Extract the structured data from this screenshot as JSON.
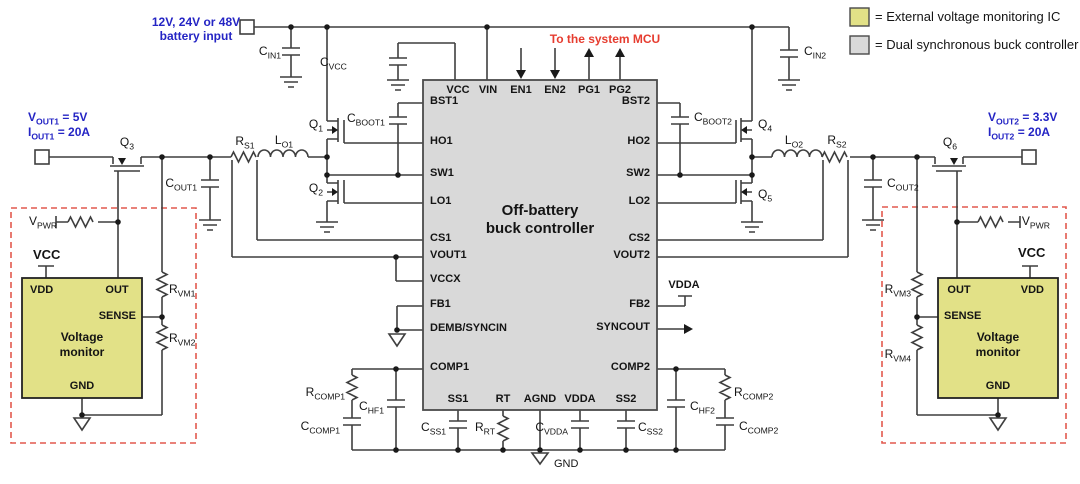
{
  "legend": {
    "items": [
      {
        "label": "= External voltage monitoring IC",
        "swatch_color": "#e2e187"
      },
      {
        "label": "= Dual synchronous buck controller",
        "swatch_color": "#d9d9d9"
      }
    ]
  },
  "annotations": {
    "battery_input": {
      "line1": "12V, 24V or 48V",
      "line2": "battery input"
    },
    "to_mcu": "To the system MCU",
    "out1_v": {
      "m": "V",
      "s": "OUT1",
      "r": " = 5V"
    },
    "out1_i": {
      "m": "I",
      "s": "OUT1",
      "r": " = 20A"
    },
    "out2_v": {
      "m": "V",
      "s": "OUT2",
      "r": " = 3.3V"
    },
    "out2_i": {
      "m": "I",
      "s": "OUT2",
      "r": " = 20A"
    },
    "vdda_rail": "VDDA",
    "gnd": "GND",
    "vcc_left": "VCC",
    "vcc_right": "VCC",
    "vpwr_left": {
      "m": "V",
      "s": "PWR"
    },
    "vpwr_right": {
      "m": "V",
      "s": "PWR"
    }
  },
  "controller": {
    "title": {
      "line1": "Off-battery",
      "line2": "buck controller"
    },
    "pins_top": [
      "VCC",
      "VIN",
      "EN1",
      "EN2",
      "PG1",
      "PG2"
    ],
    "pins_left": [
      "BST1",
      "HO1",
      "SW1",
      "LO1",
      "CS1",
      "VOUT1",
      "VCCX",
      "FB1",
      "DEMB/SYNCIN",
      "COMP1"
    ],
    "pins_right": [
      "BST2",
      "HO2",
      "SW2",
      "LO2",
      "CS2",
      "VOUT2",
      "FB2",
      "SYNCOUT",
      "COMP2"
    ],
    "pins_bottom": [
      "SS1",
      "RT",
      "AGND",
      "VDDA",
      "SS2"
    ]
  },
  "monitor_left": {
    "title": {
      "line1": "Voltage",
      "line2": "monitor"
    },
    "pins": {
      "vdd": "VDD",
      "out": "OUT",
      "sense": "SENSE",
      "gnd": "GND"
    }
  },
  "monitor_right": {
    "title": {
      "line1": "Voltage",
      "line2": "monitor"
    },
    "pins": {
      "vdd": "VDD",
      "out": "OUT",
      "sense": "SENSE",
      "gnd": "GND"
    }
  },
  "components": {
    "cin1": {
      "m": "C",
      "s": "IN1"
    },
    "cin2": {
      "m": "C",
      "s": "IN2"
    },
    "cvcc": {
      "m": "C",
      "s": "VCC"
    },
    "cboot1": {
      "m": "C",
      "s": "BOOT1"
    },
    "cboot2": {
      "m": "C",
      "s": "BOOT2"
    },
    "q1": {
      "m": "Q",
      "s": "1"
    },
    "q2": {
      "m": "Q",
      "s": "2"
    },
    "q3": {
      "m": "Q",
      "s": "3"
    },
    "q4": {
      "m": "Q",
      "s": "4"
    },
    "q5": {
      "m": "Q",
      "s": "5"
    },
    "q6": {
      "m": "Q",
      "s": "6"
    },
    "lo1": {
      "m": "L",
      "s": "O1"
    },
    "lo2": {
      "m": "L",
      "s": "O2"
    },
    "rs1": {
      "m": "R",
      "s": "S1"
    },
    "rs2": {
      "m": "R",
      "s": "S2"
    },
    "cout1": {
      "m": "C",
      "s": "OUT1"
    },
    "cout2": {
      "m": "C",
      "s": "OUT2"
    },
    "rvm1": {
      "m": "R",
      "s": "VM1"
    },
    "rvm2": {
      "m": "R",
      "s": "VM2"
    },
    "rvm3": {
      "m": "R",
      "s": "VM3"
    },
    "rvm4": {
      "m": "R",
      "s": "VM4"
    },
    "rcomp1": {
      "m": "R",
      "s": "COMP1"
    },
    "rcomp2": {
      "m": "R",
      "s": "COMP2"
    },
    "chf1": {
      "m": "C",
      "s": "HF1"
    },
    "chf2": {
      "m": "C",
      "s": "HF2"
    },
    "ccomp1": {
      "m": "C",
      "s": "COMP1"
    },
    "ccomp2": {
      "m": "C",
      "s": "COMP2"
    },
    "css1": {
      "m": "C",
      "s": "SS1"
    },
    "css2": {
      "m": "C",
      "s": "SS2"
    },
    "rrt": {
      "m": "R",
      "s": "RT"
    },
    "cvdda": {
      "m": "C",
      "s": "VDDA"
    }
  },
  "colors": {
    "controller_fill": "#d9d9d9",
    "monitor_fill": "#e2e187",
    "wire": "#3f3f3f",
    "blue_text": "#2424c4",
    "red_text": "#e63c2f",
    "dashed_red": "#e2594e"
  }
}
